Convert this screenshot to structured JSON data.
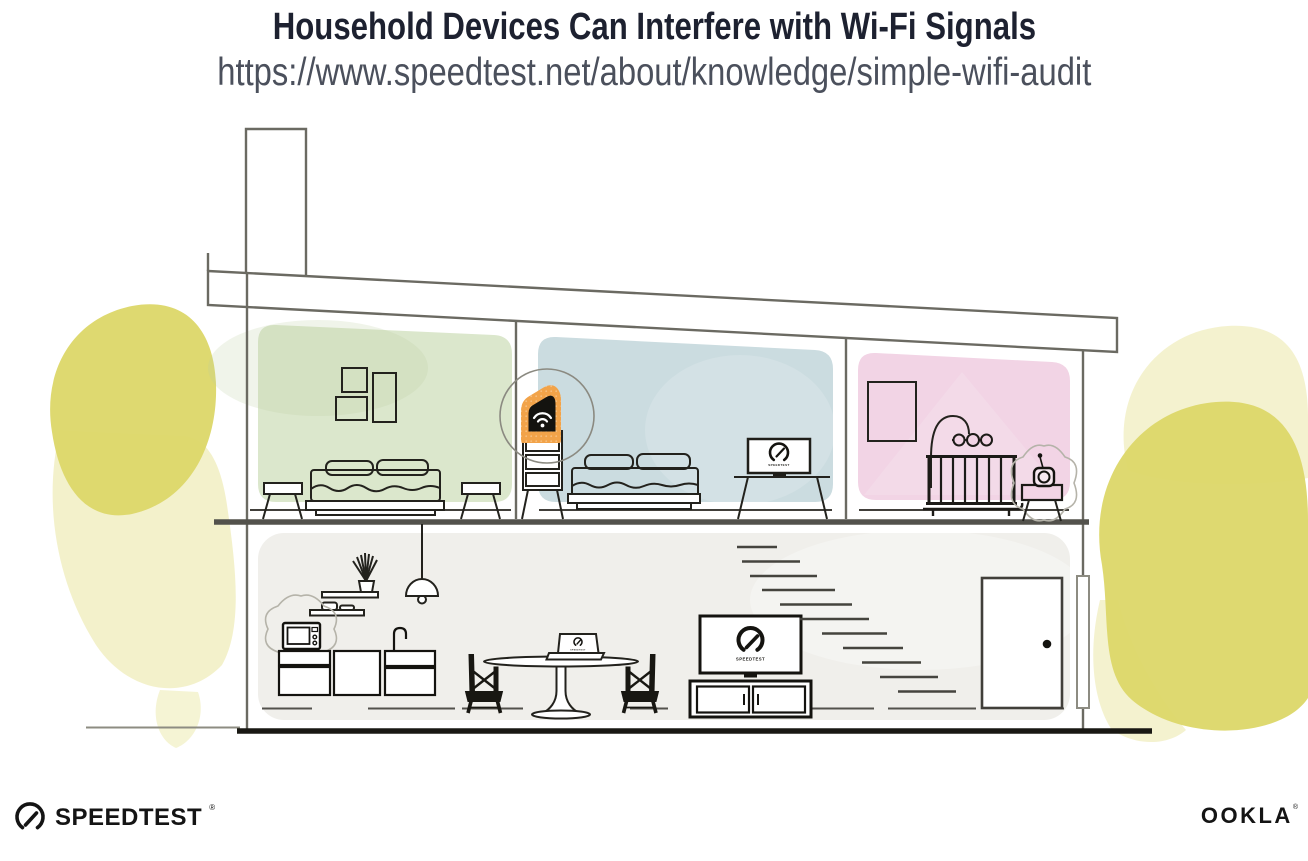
{
  "header": {
    "title": "Household Devices Can Interfere with Wi-Fi Signals",
    "url": "https://www.speedtest.net/about/knowledge/simple-wifi-audit"
  },
  "branding": {
    "speedtest_wordmark": "SPEEDTEST",
    "speedtest_trademark": "®",
    "ookla_wordmark": "OOKLA",
    "ookla_trademark": "®"
  },
  "illustration": {
    "bedroom_tv_label": "SPEEDTEST",
    "living_tv_label": "SPEEDTEST",
    "laptop_label": "SPEEDTEST"
  },
  "icons": {
    "router_wifi": "wifi-arcs",
    "speedtest_gauge": "gauge-with-needle",
    "interference": "squiggle-burst"
  },
  "colors": {
    "title_text": "#1d2130",
    "url_text": "#4b505c",
    "accent_orange": "#f2a349",
    "room_green": "#dbe7cc",
    "room_blue": "#cbdce0",
    "room_pink": "#f2d4e5",
    "room_gray": "#f0efeb",
    "foliage_yellow": "#dcd768",
    "foliage_soft": "#e9e6a0",
    "ink": "#14130f",
    "structure_gray": "#6b6a62"
  }
}
